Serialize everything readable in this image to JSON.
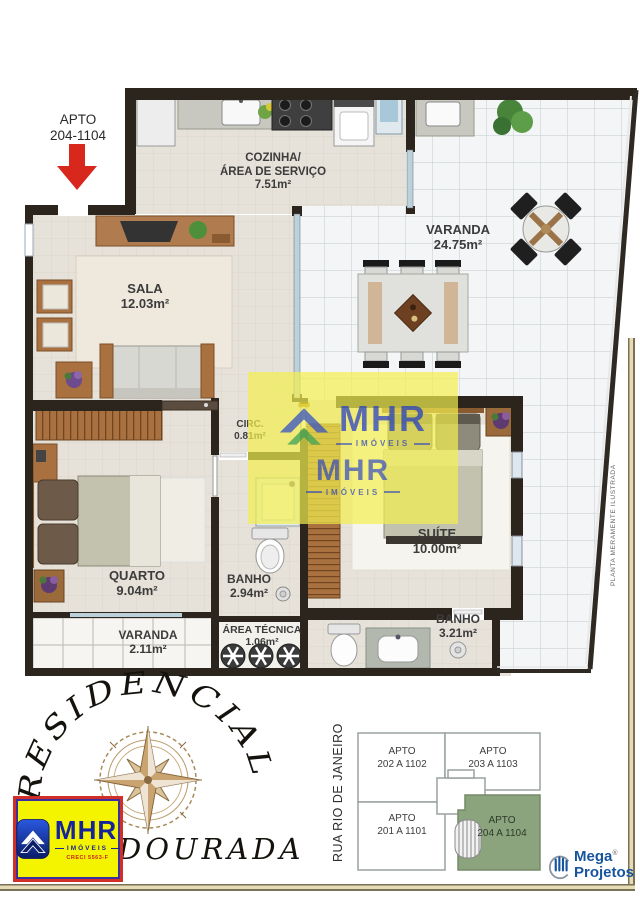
{
  "callout": {
    "line1": "APTO",
    "line2": "204-1104"
  },
  "rooms": {
    "cozinha": {
      "name1": "COZINHA/",
      "name2": "ÁREA DE SERVIÇO",
      "area": "7.51m²"
    },
    "varanda": {
      "name": "VARANDA",
      "area": "24.75m²"
    },
    "sala": {
      "name": "SALA",
      "area": "12.03m²"
    },
    "circ": {
      "name": "CIRC.",
      "area": "0.81m²"
    },
    "suite": {
      "name": "SUÍTE",
      "area": "10.00m²"
    },
    "quarto": {
      "name": "QUARTO",
      "area": "9.04m²"
    },
    "banho_social": {
      "name": "BANHO",
      "area": "2.94m²"
    },
    "varanda_quarto": {
      "name": "VARANDA",
      "area": "2.11m²"
    },
    "area_tecnica": {
      "name": "ÁREA TÉCNICA",
      "area": "1.06m²"
    },
    "banho_suite": {
      "name": "BANHO",
      "area": "3.21m²"
    }
  },
  "side_note": "PLANTA MERAMENTE ILUSTRADA",
  "watermark": {
    "name": "MHR",
    "subtitle": "IMÓVEIS",
    "name2": "MHR",
    "subtitle2": "IMÓVEIS"
  },
  "branding": {
    "residencial": "RESIDENCIAL",
    "dourada": "DOURADA",
    "mhr": {
      "name": "MHR",
      "subtitle": "IMÓVEIS",
      "creci": "CRECI 5563-F"
    }
  },
  "site_plan": {
    "street": "RUA RIO DE JANEIRO",
    "units": [
      {
        "line1": "APTO",
        "line2": "202 A 1102"
      },
      {
        "line1": "APTO",
        "line2": "203 A 1103"
      },
      {
        "line1": "APTO",
        "line2": "201 A 1101"
      },
      {
        "line1": "APTO",
        "line2": "204 A 1104"
      }
    ]
  },
  "mega": {
    "line1": "Mega",
    "reg": "®",
    "line2": "Projetos"
  },
  "colors": {
    "wall": "#2b251e",
    "arrow_red": "#d8281e",
    "wood": "#a9713f",
    "tile_grout": "#ccd2d6",
    "highlight_green": "#8ba47e",
    "mhr_blue": "#16249a",
    "mhr_yellow": "#f4f400",
    "mhr_red": "#d03028",
    "mega_blue": "#17549e",
    "watermark_yellow": "#f3ef4e"
  }
}
